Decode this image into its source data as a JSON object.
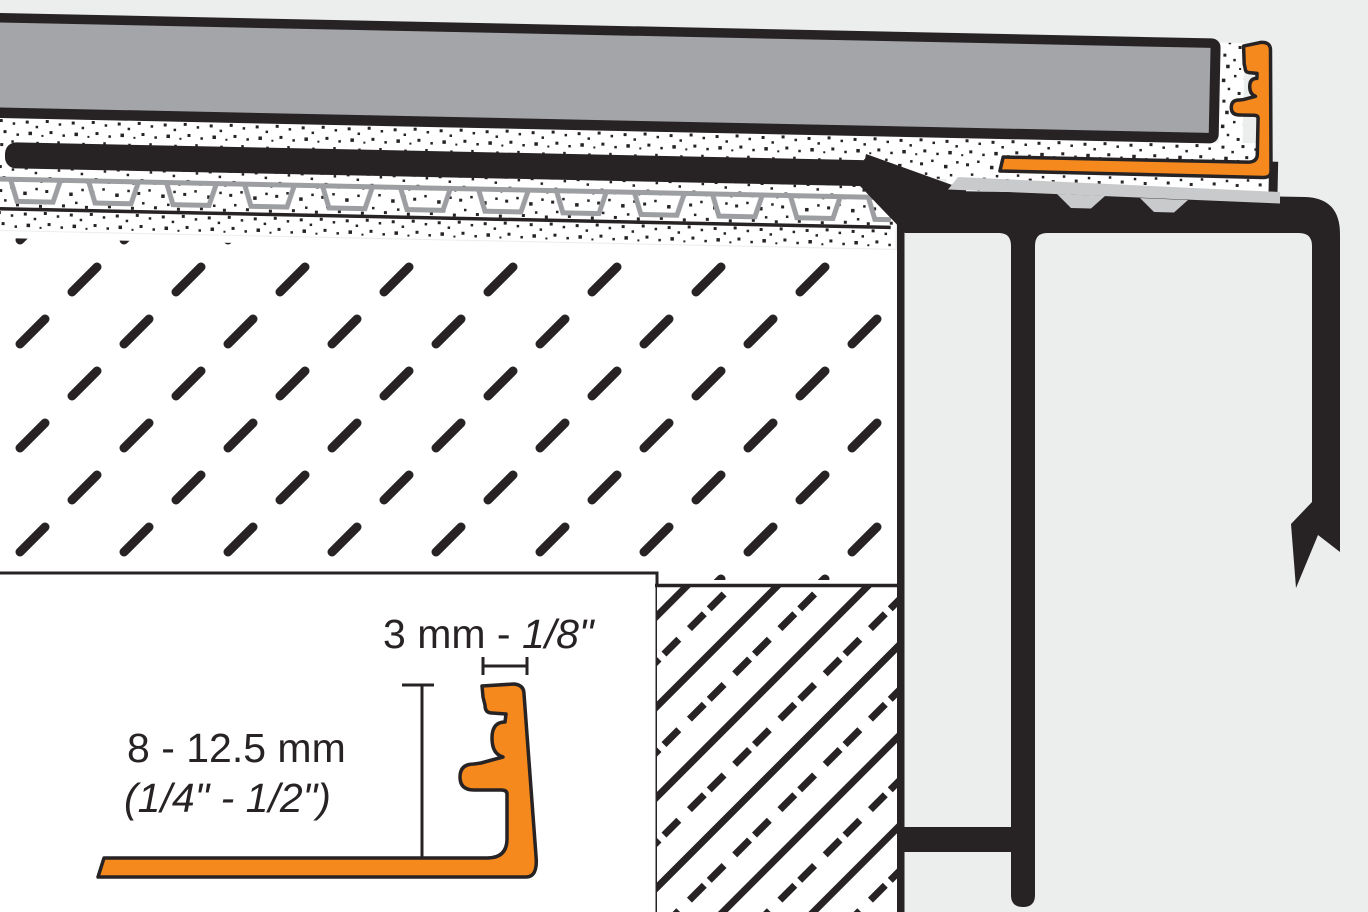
{
  "diagram": {
    "type": "installation-cross-section",
    "inset_detail": {
      "width_dimension": {
        "metric_prefix": "3 mm - ",
        "imperial": "1/8\""
      },
      "height_dimension": {
        "metric": "8 - 12.5 mm",
        "imperial": "(1/4\" - 1/2\")"
      }
    },
    "colors": {
      "background": "#ECEDED",
      "line_black": "#272324",
      "profile_orange": "#F6891E",
      "tile_gray": "#A3A5A8",
      "support_gray": "#C9CACC",
      "membrane_gray": "#9C9EA1"
    }
  }
}
